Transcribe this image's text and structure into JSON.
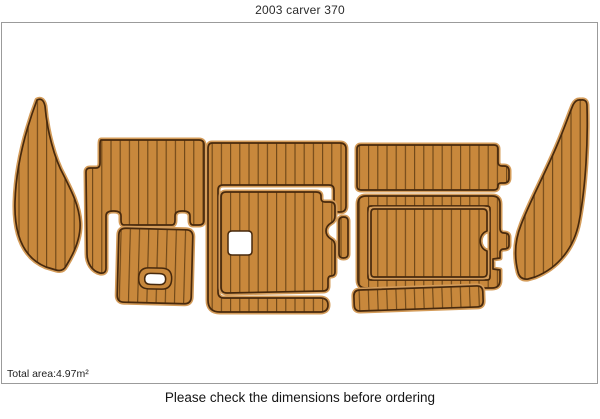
{
  "page": {
    "title": "2003 carver 370"
  },
  "diagram": {
    "total_area_label": "Total area:4.97m²",
    "footer_note": "Please check the dimensions before ordering",
    "colors": {
      "background": "#ffffff",
      "frame_border": "#9b9b9b",
      "teak_fill": "#c8883c",
      "teak_edge": "#d49c5a",
      "outline": "#47290d",
      "plank_line": "#6b4517",
      "hole_fill": "#ffffff",
      "text": "#2b2b2b"
    },
    "pieces": [
      {
        "name": "left-wing-pad"
      },
      {
        "name": "left-cockpit-pad"
      },
      {
        "name": "left-step-pad"
      },
      {
        "name": "center-bracket-pad"
      },
      {
        "name": "center-main-pad"
      },
      {
        "name": "center-divider-pad"
      },
      {
        "name": "right-top-pad"
      },
      {
        "name": "right-frame-pad"
      },
      {
        "name": "right-inner-pad"
      },
      {
        "name": "right-bottom-pad"
      },
      {
        "name": "right-wing-pad"
      }
    ]
  }
}
